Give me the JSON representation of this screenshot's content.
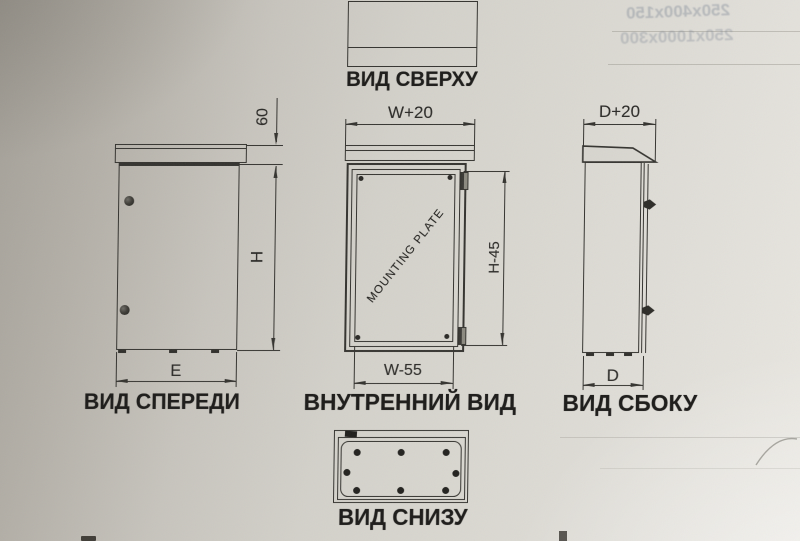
{
  "views": {
    "top": {
      "label": "ВИД СВЕРХУ"
    },
    "front": {
      "label": "ВИД СПЕРЕДИ",
      "dim_roof": "60",
      "dim_height": "H",
      "dim_width": "E"
    },
    "internal": {
      "label": "ВНУТРЕННИЙ ВИД",
      "plate_label": "MOUNTING PLATE",
      "dim_width_top": "W+20",
      "dim_plate_height": "H-45",
      "dim_plate_width": "W-55"
    },
    "side": {
      "label": "ВИД СБОКУ",
      "dim_depth_top": "D+20",
      "dim_depth": "D"
    },
    "bottom": {
      "label": "ВИД СНИЗУ"
    }
  },
  "bleedthrough": {
    "line1": "250x400x150",
    "line2": "250x1000x300"
  },
  "colors": {
    "line": "#34332f",
    "text": "#1c1b19",
    "paper_dark": "#a29e96",
    "paper_light": "#e9e7e1"
  }
}
